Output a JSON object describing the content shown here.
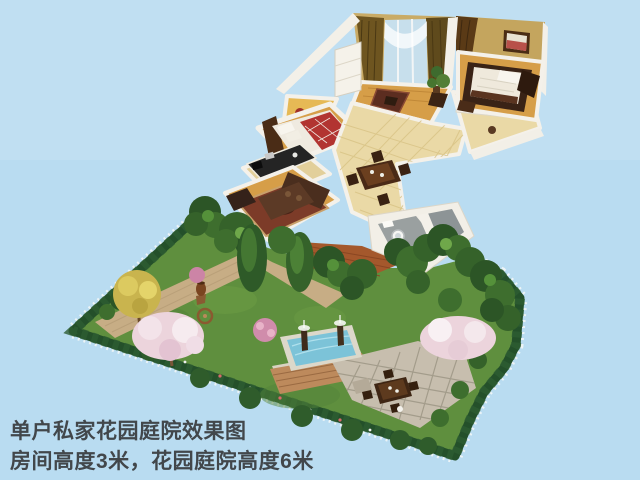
{
  "caption": {
    "line1": "单户私家花园庭院效果图",
    "line2": "房间高度3米，花园庭院高度6米"
  },
  "colors": {
    "sky": "#b9dcf1",
    "caption_text": "#42474b",
    "lawn": "#5f8f3e",
    "hedge": "#24502a",
    "fence": "#eef4f7",
    "path": "#c7ad85",
    "pool_water": "#7cc3d8",
    "pool_rim": "#dcd8ca",
    "stone_patio": "#c7beae",
    "brick_patio": "#bd8a5c",
    "deck_wood": "#a4582c",
    "blossom_pink": "#ecd4dc",
    "autumn_yellow": "#c9b44e",
    "house_wall": "#f3f0e8",
    "wood_floor": "#d69e48",
    "tile_floor": "#ead9a6",
    "window_glass": "#c7dfec",
    "curtain_gold": "#6e5520",
    "bed_red": "#b23431",
    "rug_red": "#7c3b28",
    "counter_black": "#242424",
    "dark_furniture": "#4a2e1e"
  }
}
